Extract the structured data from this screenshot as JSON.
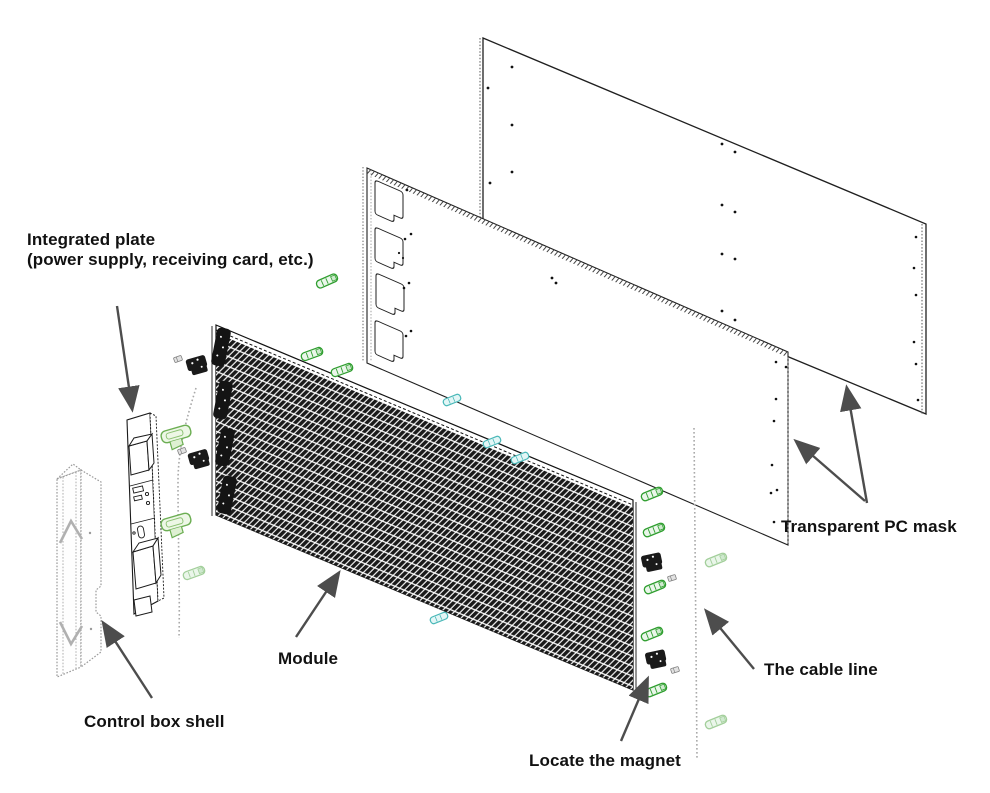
{
  "diagram": {
    "type": "exploded-assembly-drawing",
    "subject": "LED display module assembly",
    "labels": {
      "integrated_plate": {
        "line1": "Integrated plate",
        "line2": "(power supply, receiving card, etc.)"
      },
      "module": {
        "text": "Module"
      },
      "control_box_shell": {
        "text": "Control box shell"
      },
      "locate_the_magnet": {
        "text": "Locate the magnet"
      },
      "transparent_pc_mask": {
        "text": "Transparent PC mask"
      },
      "the_cable_line": {
        "text": "The cable line"
      }
    },
    "colors": {
      "background": "#ffffff",
      "line_art": "#1a1a1a",
      "arrow": "#4d4d4d",
      "clip_green": "#2f9e2f",
      "clip_green_large": "#6cae53",
      "clip_green_faded": "#a3cf9b",
      "tag_teal": "#49b8b8",
      "shell_gray": "#9a9a9a",
      "module_fill": "#1a1a1a",
      "cable_dotted": "#a9a9a9"
    }
  }
}
